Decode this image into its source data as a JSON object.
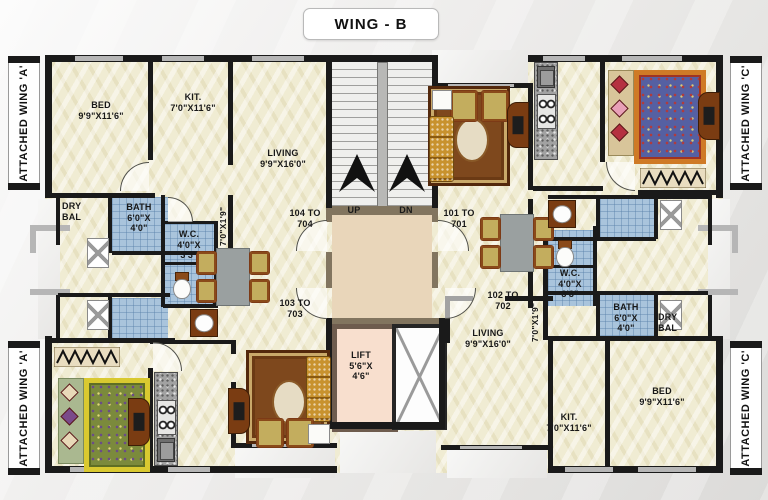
{
  "title": "WING - B",
  "wings": {
    "left_top": "ATTACHED WING 'A'",
    "left_bottom": "ATTACHED WING 'A'",
    "right_top": "ATTACHED WING 'C'",
    "right_bottom": "ATTACHED WING 'C'"
  },
  "labels": {
    "bed": {
      "name": "BED",
      "dim": "9'9\"X11'6\""
    },
    "kit": {
      "name": "KIT.",
      "dim": "7'0\"X11'6\""
    },
    "living": {
      "name": "LIVING",
      "dim": "9'9\"X16'0\""
    },
    "dry_bal": "DRY BAL",
    "bath": {
      "name": "BATH",
      "l1": "6'0\"X",
      "l2": "4'0\""
    },
    "wc": {
      "name": "W.C.",
      "l1": "4'0\"X",
      "l2": "3'3\""
    },
    "passage": "7'0\"X1'9\"",
    "lift": {
      "name": "LIFT",
      "l1": "5'6\"X",
      "l2": "4'6\""
    }
  },
  "stairs": {
    "up": "UP",
    "dn": "DN"
  },
  "doors": {
    "d104": "104 TO 704",
    "d101": "101 TO 701",
    "d103": "103 TO 703",
    "d102": "102 TO 702"
  },
  "colors": {
    "wall": "#1a1a1a",
    "brownwall": "#82755f",
    "window": "#b6b6b6",
    "floor": "#f0ecd3",
    "tile": "#a9c4dc",
    "lobby": "#e9d6ba",
    "lift_floor": "#f8dfce",
    "carpet": "#7e481d",
    "sofa": "#c8922e",
    "granite": "#a2a2a2",
    "wood": "#7a3c12",
    "bed_blue": "#5560a2",
    "bed_green": "#7b8a3c"
  }
}
